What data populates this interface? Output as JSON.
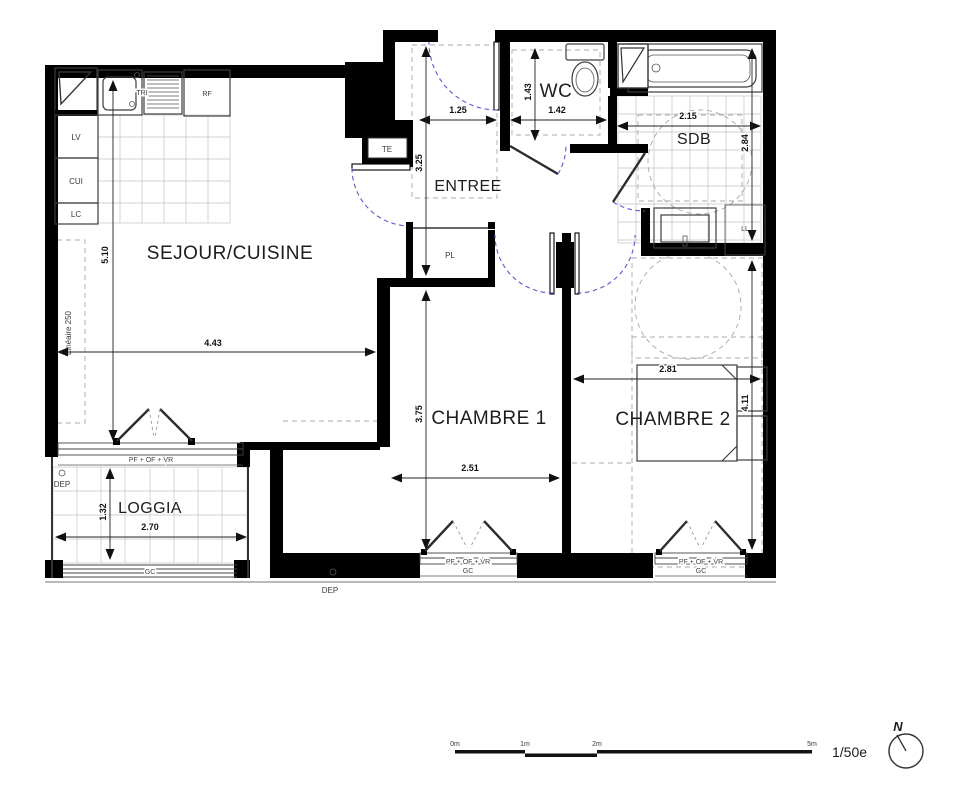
{
  "rooms": {
    "sejour": "SEJOUR/CUISINE",
    "entree": "ENTREE",
    "wc": "WC",
    "sdb": "SDB",
    "chambre1": "CHAMBRE 1",
    "chambre2": "CHAMBRE 2",
    "loggia": "LOGGIA"
  },
  "fixtures": {
    "lv": "LV",
    "cui": "CUI",
    "lc": "LC",
    "tri": "TRI",
    "rf": "RF",
    "te": "TE",
    "pl": "PL",
    "ll": "LL",
    "dep": "DEP",
    "lineaire": "Linéaire 250",
    "window_code": "PF + OF + VR",
    "guard_rail": "GC"
  },
  "dimensions": {
    "sejour_width": "4.43",
    "sejour_height": "5.10",
    "entree_width": "1.25",
    "entree_height": "3.25",
    "wc_width": "1.42",
    "wc_height": "1.43",
    "sdb_width": "2.15",
    "sdb_height": "2.84",
    "chambre1_width": "2.51",
    "chambre1_height": "3.75",
    "chambre2_width": "2.81",
    "chambre2_height": "4.11",
    "loggia_width": "2.70",
    "loggia_height": "1.32"
  },
  "scale_bar": {
    "ticks": [
      "0m",
      "1m",
      "2m",
      "5m"
    ],
    "ratio": "1/50e",
    "north": "N"
  }
}
